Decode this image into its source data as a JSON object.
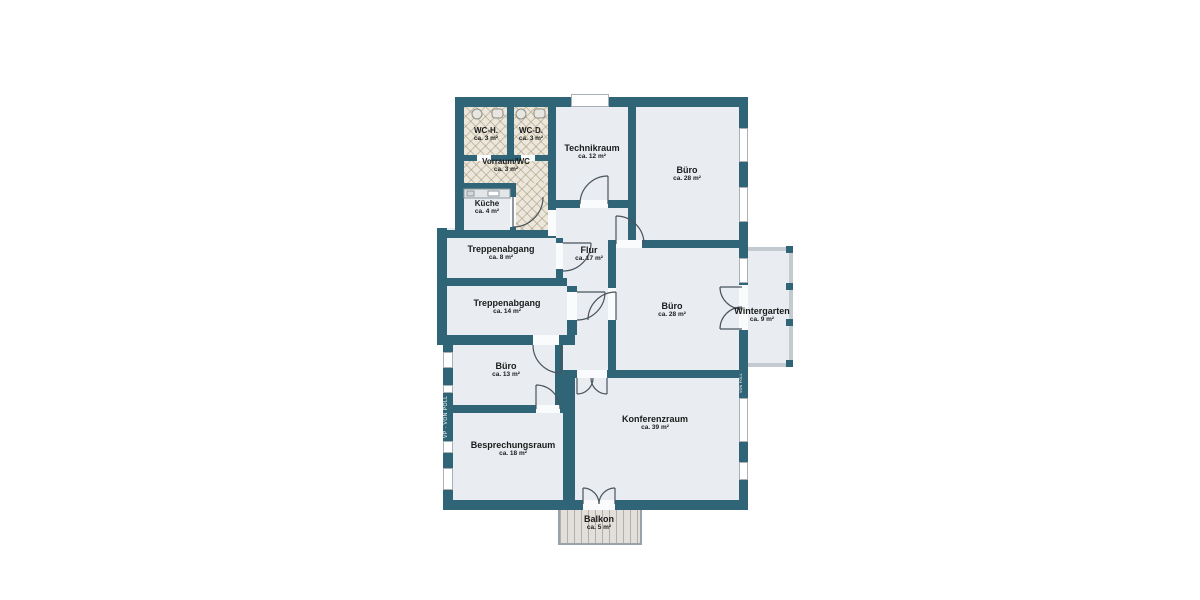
{
  "plan": {
    "title": "Grundriss Obergeschoss",
    "rooms": [
      {
        "id": "wc-h",
        "name": "WC-H.",
        "area": "ca. 3 m²"
      },
      {
        "id": "wc-d",
        "name": "WC-D.",
        "area": "ca. 3 m²"
      },
      {
        "id": "vorraum-wc",
        "name": "Vorraum/WC",
        "area": "ca. 3 m²"
      },
      {
        "id": "kueche",
        "name": "Küche",
        "area": "ca. 4 m²"
      },
      {
        "id": "technikraum",
        "name": "Technikraum",
        "area": "ca. 12 m²"
      },
      {
        "id": "buero-oben",
        "name": "Büro",
        "area": "ca. 28 m²"
      },
      {
        "id": "treppenabgang-8",
        "name": "Treppenabgang",
        "area": "ca. 8 m²"
      },
      {
        "id": "flur",
        "name": "Flur",
        "area": "ca. 17 m²"
      },
      {
        "id": "treppenabgang-14",
        "name": "Treppenabgang",
        "area": "ca. 14 m²"
      },
      {
        "id": "buero-mitte",
        "name": "Büro",
        "area": "ca. 28 m²"
      },
      {
        "id": "wintergarten",
        "name": "Wintergarten",
        "area": "ca. 9 m²"
      },
      {
        "id": "buero-13",
        "name": "Büro",
        "area": "ca. 13 m²"
      },
      {
        "id": "besprechungsraum",
        "name": "Besprechungsraum",
        "area": "ca. 18 m²"
      },
      {
        "id": "konferenzraum",
        "name": "Konferenzraum",
        "area": "ca. 39 m²"
      },
      {
        "id": "balkon",
        "name": "Balkon",
        "area": "ca. 5 m²"
      }
    ],
    "watermark": {
      "left": "VP · VON POLL",
      "right": "VON POLL"
    },
    "colors": {
      "wall": "#2F6577",
      "floor": "#E9EDF1",
      "tile": "#ECE7DA",
      "balcony": "#E2DED9",
      "glass": "#C3CBD1"
    }
  }
}
